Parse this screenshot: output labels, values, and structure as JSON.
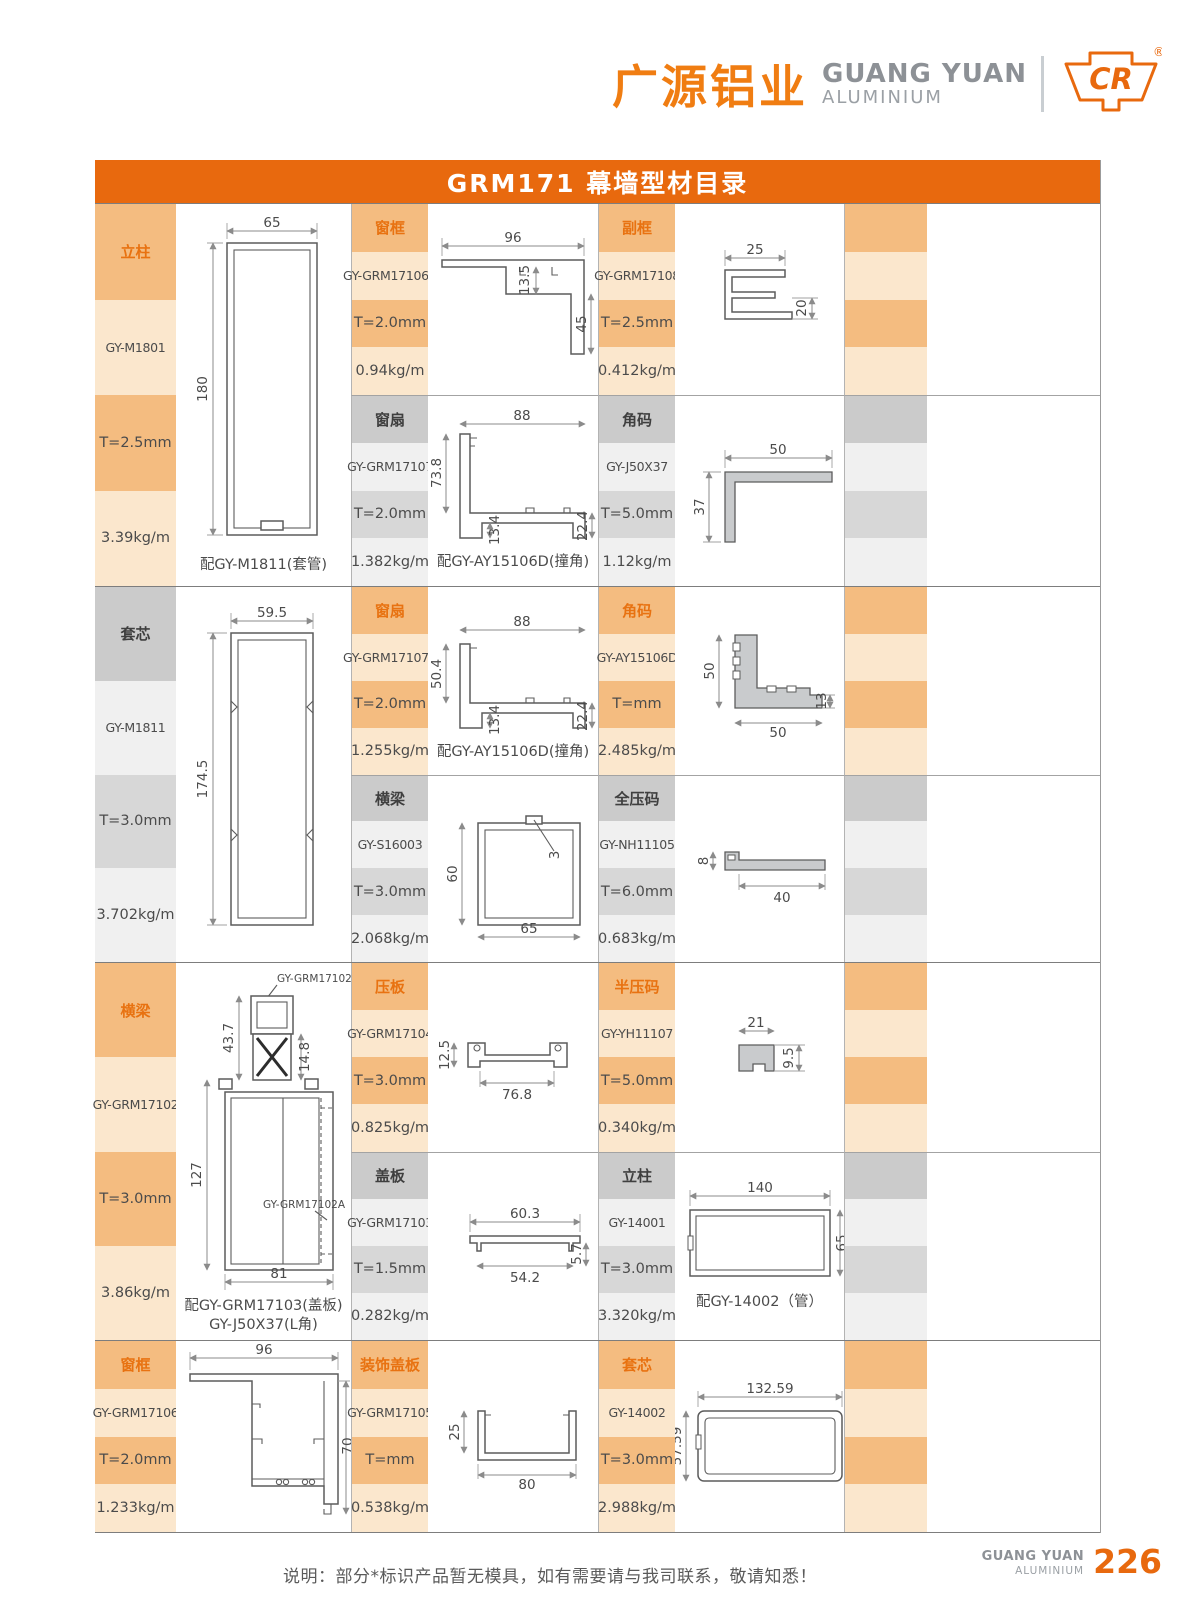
{
  "header": {
    "brand_cn": "广源铝业",
    "brand_en": "GUANG YUAN",
    "brand_sub": "ALUMINIUM",
    "logo_mark": "CR",
    "reg_mark": "®"
  },
  "title": "GRM171 幕墙型材目录",
  "colors": {
    "accent_orange": "#E8690E",
    "band_orange": "#F4BC80",
    "band_orange_light": "#FBE7CD",
    "band_gray": "#CBCBCB",
    "band_gray_mid": "#D7D7D7",
    "band_gray_light": "#F0F0F0"
  },
  "groups": [
    {
      "left": {
        "label": "立柱",
        "model": "GY-M1801",
        "thickness": "T=2.5mm",
        "weight": "3.39kg/m",
        "caption": "配GY-M1811(套管)",
        "dims": {
          "width": "65",
          "height": "180"
        }
      },
      "mid": [
        {
          "label": "窗框",
          "model": "GY-GRM17106A",
          "thickness": "T=2.0mm",
          "weight": "0.94kg/m",
          "dims": {
            "width": "96",
            "mid": "13.5",
            "right": "45"
          }
        },
        {
          "label": "窗扇",
          "model": "GY-GRM17107",
          "thickness": "T=2.0mm",
          "weight": "1.382kg/m",
          "caption": "配GY-AY15106D(撞角)",
          "dims": {
            "width": "88",
            "left": "73.8",
            "foot": "13.4",
            "right": "22.4"
          }
        }
      ],
      "right": [
        {
          "label": "副框",
          "model": "GY-GRM17108",
          "thickness": "T=2.5mm",
          "weight": "0.412kg/m",
          "dims": {
            "width": "25",
            "right": "20"
          }
        },
        {
          "label": "角码",
          "model": "GY-J50X37",
          "thickness": "T=5.0mm",
          "weight": "1.12kg/m",
          "dims": {
            "width": "50",
            "left": "37"
          }
        }
      ]
    },
    {
      "left": {
        "label": "套芯",
        "model": "GY-M1811",
        "thickness": "T=3.0mm",
        "weight": "3.702kg/m",
        "dims": {
          "width": "59.5",
          "height": "174.5"
        }
      },
      "mid": [
        {
          "label": "窗扇",
          "model": "GY-GRM17107A",
          "thickness": "T=2.0mm",
          "weight": "1.255kg/m",
          "caption": "配GY-AY15106D(撞角)",
          "dims": {
            "width": "88",
            "left": "50.4",
            "foot": "13.4",
            "right": "22.4"
          }
        },
        {
          "label": "横梁",
          "model": "GY-S16003",
          "thickness": "T=3.0mm",
          "weight": "2.068kg/m",
          "dims": {
            "left": "60",
            "bottom": "65",
            "notch": "3"
          }
        }
      ],
      "right": [
        {
          "label": "角码",
          "model": "GY-AY15106D",
          "thickness": "T=mm",
          "weight": "2.485kg/m",
          "dims": {
            "left": "50",
            "bottom": "50",
            "right": "13"
          }
        },
        {
          "label": "全压码",
          "model": "GY-NH11105",
          "thickness": "T=6.0mm",
          "weight": "0.683kg/m",
          "dims": {
            "left": "8",
            "bottom": "40"
          }
        }
      ]
    },
    {
      "left": {
        "label": "横梁",
        "model": "GY-GRM17102",
        "thickness": "T=3.0mm",
        "weight": "3.86kg/m",
        "caption": "配GY-GRM17103(盖板)",
        "caption2": "GY-J50X37(L角)",
        "dims": {
          "top": "43.7",
          "inner": "14.8",
          "left": "127",
          "bottom": "81",
          "callout_top": "GY-GRM17102B",
          "callout_mid": "GY-GRM17102A"
        }
      },
      "mid": [
        {
          "label": "压板",
          "model": "GY-GRM17104",
          "thickness": "T=3.0mm",
          "weight": "0.825kg/m",
          "dims": {
            "left": "12.5",
            "bottom": "76.8"
          }
        },
        {
          "label": "盖板",
          "model": "GY-GRM17103",
          "thickness": "T=1.5mm",
          "weight": "0.282kg/m",
          "dims": {
            "top": "60.3",
            "bottom": "54.2",
            "right": "5.7"
          }
        }
      ],
      "right": [
        {
          "label": "半压码",
          "model": "GY-YH11107",
          "thickness": "T=5.0mm",
          "weight": "0.340kg/m",
          "dims": {
            "width": "21",
            "right": "9.5"
          }
        },
        {
          "label": "立柱",
          "model": "GY-14001",
          "thickness": "T=3.0mm",
          "weight": "3.320kg/m",
          "caption": "配GY-14002（管）",
          "dims": {
            "width": "140",
            "right": "65"
          }
        }
      ]
    },
    {
      "left": {
        "label": "窗框",
        "model": "GY-GRM17106",
        "thickness": "T=2.0mm",
        "weight": "1.233kg/m",
        "dims": {
          "width": "96",
          "right": "70"
        }
      },
      "mid": [
        {
          "label": "装饰盖板",
          "model": "GY-GRM17105",
          "thickness": "T=mm",
          "weight": "0.538kg/m",
          "dims": {
            "left": "25",
            "bottom": "80"
          }
        }
      ],
      "right": [
        {
          "label": "套芯",
          "model": "GY-14002",
          "thickness": "T=3.0mm",
          "weight": "2.988kg/m",
          "dims": {
            "width": "132.59",
            "left": "57.59"
          }
        }
      ]
    }
  ],
  "footer": {
    "note": "说明：部分*标识产品暂无模具，如有需要请与我司联系，敬请知悉！",
    "brand_en": "GUANG YUAN",
    "brand_sub": "ALUMINIUM",
    "page_number": "226"
  }
}
